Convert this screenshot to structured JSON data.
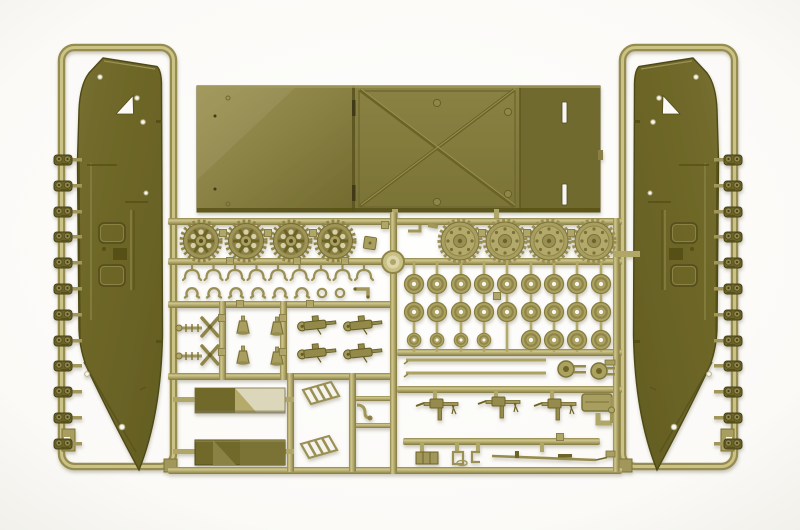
{
  "image": {
    "type": "photograph",
    "subject": "Injection-moulded olive-drab plastic model-kit sprue with hull side panels, deck panel with X cross-bracing, drive sprockets, road wheels, track links and small fittings of an amphibious tracked vehicle, photographed on a white background",
    "background_color": "#fbfaf7"
  },
  "palette": {
    "hull_olive": "#6c6526",
    "hull_olive_dark": "#514c1e",
    "hull_olive_light": "#8a8448",
    "runner_tan": "#b2a86a",
    "runner_tan_dark": "#8a8049",
    "runner_tan_light": "#d3cc98",
    "deck_olive_mid": "#847c3e",
    "deck_olive_dark": "#6f6a2d",
    "panel_cream": "#dcd6bb",
    "hole_white": "#f7f6f2"
  },
  "parts": {
    "hull_sides": {
      "label": "large hull side panels with curved bow",
      "count": 2
    },
    "deck_panel": {
      "label": "deck / ramp panel with X cross-bracing and slotted end plate",
      "count": 1
    },
    "spoked_sprockets": {
      "label": "spoked drive sprocket wheels",
      "count": 4
    },
    "toothed_idlers": {
      "label": "solid toothed idler wheels",
      "count": 4
    },
    "road_wheels": {
      "label": "small road wheels",
      "count": 26
    },
    "track_link_runs": {
      "label": "track link sections along hull edges",
      "count": 24
    },
    "suspension_forks": {
      "label": "suspension fork parts",
      "count": 9
    },
    "spring_arches": {
      "label": "small arch brackets",
      "count": 6
    },
    "bell_mounts": {
      "label": "cone shaped mounts",
      "count": 4
    },
    "gun_assemblies": {
      "label": "machine gun assemblies",
      "count": 7
    },
    "rifle": {
      "label": "long rifle with bayonet",
      "count": 1
    },
    "louvered_grilles": {
      "label": "louvered intake grilles",
      "count": 2
    },
    "two_tone_panels": {
      "label": "rectangular pontoon panels",
      "count": 2
    },
    "barrel_rods": {
      "label": "long thin barrel rods",
      "count": 2
    }
  }
}
